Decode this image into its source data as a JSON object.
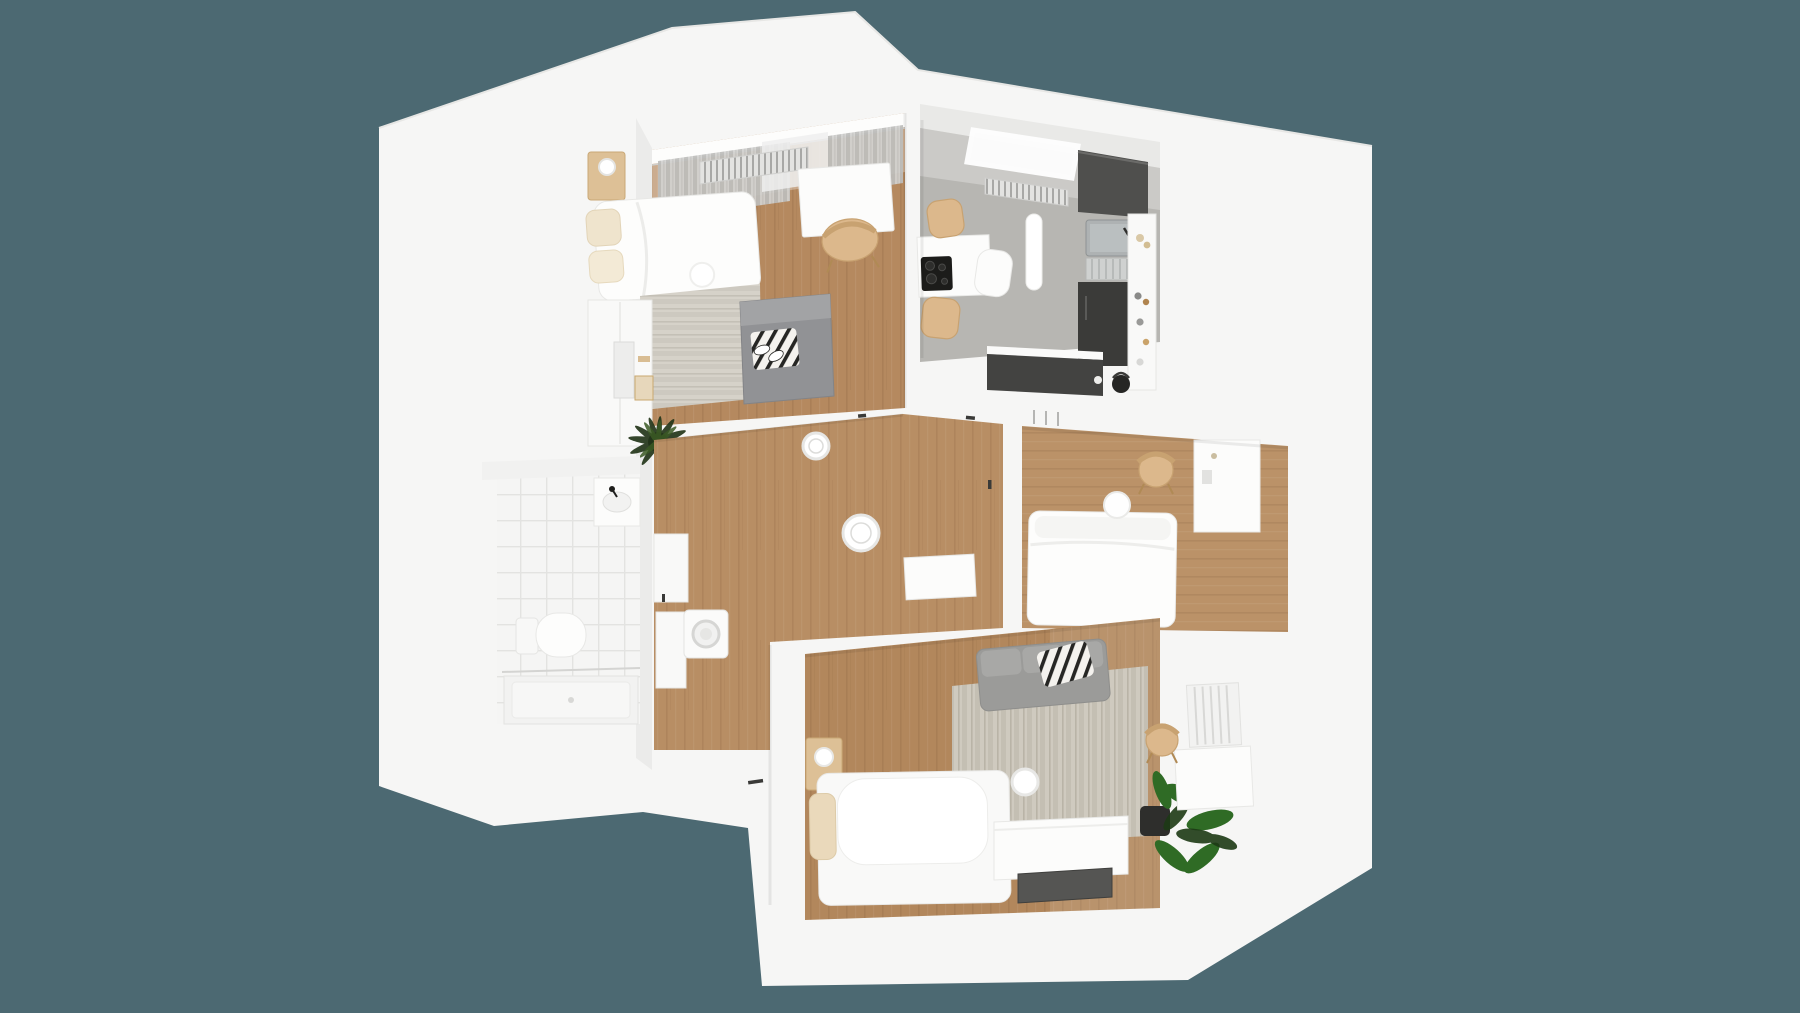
{
  "scene": {
    "kind": "3d-floor-plan-render",
    "view": "top-down isometric render of a small apartment, white shell walls on a dark slate-teal backdrop",
    "rooms": [
      {
        "id": "bedroom-top-left",
        "floor": "oak wood",
        "items": [
          "curtained window wall",
          "radiator",
          "wood nightstand with lamp",
          "double bed with beige pillows",
          "white desk",
          "wood chair",
          "striped light rug",
          "gray futon sofa with striped blanket and sneakers",
          "white wardrobe with vanity mirror",
          "palm plant"
        ]
      },
      {
        "id": "kitchen-top-right",
        "floor": "gray vinyl",
        "items": [
          "skylight",
          "radiator",
          "capsule ceiling light",
          "white dining island with black cooktop",
          "two wood chairs",
          "white shell chair",
          "dark counter with steel sink",
          "dish rack",
          "dark lower cabinets",
          "white wall shelf with jars",
          "dark peninsula counter with kettle"
        ]
      },
      {
        "id": "bathroom-left",
        "floor": "white tile",
        "items": [
          "washbasin with black faucet",
          "wall-hung toilet",
          "walk-in shower tray"
        ]
      },
      {
        "id": "hallway-center",
        "floor": "oak wood",
        "items": [
          "two round ceiling lights",
          "washing machine",
          "storage shelves",
          "white console table",
          "entry door with dark handle"
        ]
      },
      {
        "id": "bedroom-middle-right",
        "floor": "oak wood",
        "items": [
          "radiator",
          "white bed",
          "round white side table",
          "wood chair",
          "white desk"
        ]
      },
      {
        "id": "living-room-bottom",
        "floor": "oak wood",
        "items": [
          "gray sofa with black-and-white striped blanket",
          "striped area rug",
          "bed with large white pillow and beige cushion",
          "wood nightstand with lamp",
          "round ceiling light",
          "white sideboard",
          "dark tv panel",
          "potted green plant",
          "white radiator",
          "white desk",
          "wood chair"
        ]
      }
    ]
  },
  "colors": {
    "background": "#4c6972",
    "shell": "#f6f6f5",
    "wallshadow": "#e4e4e2",
    "wood1": "#b5895f",
    "woodhall": "#b88e64",
    "wood2": "#bb9268",
    "woodliv": "#b2875c",
    "kfloor": "#b7b6b2",
    "tile": "#f5f5f4",
    "ruglight": "#d6d2c9",
    "rugliving": "#cfcabf",
    "sofa": "#9b9b99",
    "futon": "#919295",
    "counterdark": "#4f4f4d",
    "cabinetdark": "#3b3b39",
    "chairtan": "#dcb88c",
    "furnwood": "#ddc096",
    "plant": "#2f6b25",
    "plantdark": "#1d3a15",
    "cooktop": "#1c1c1a",
    "steel": "#aeb2b3"
  }
}
